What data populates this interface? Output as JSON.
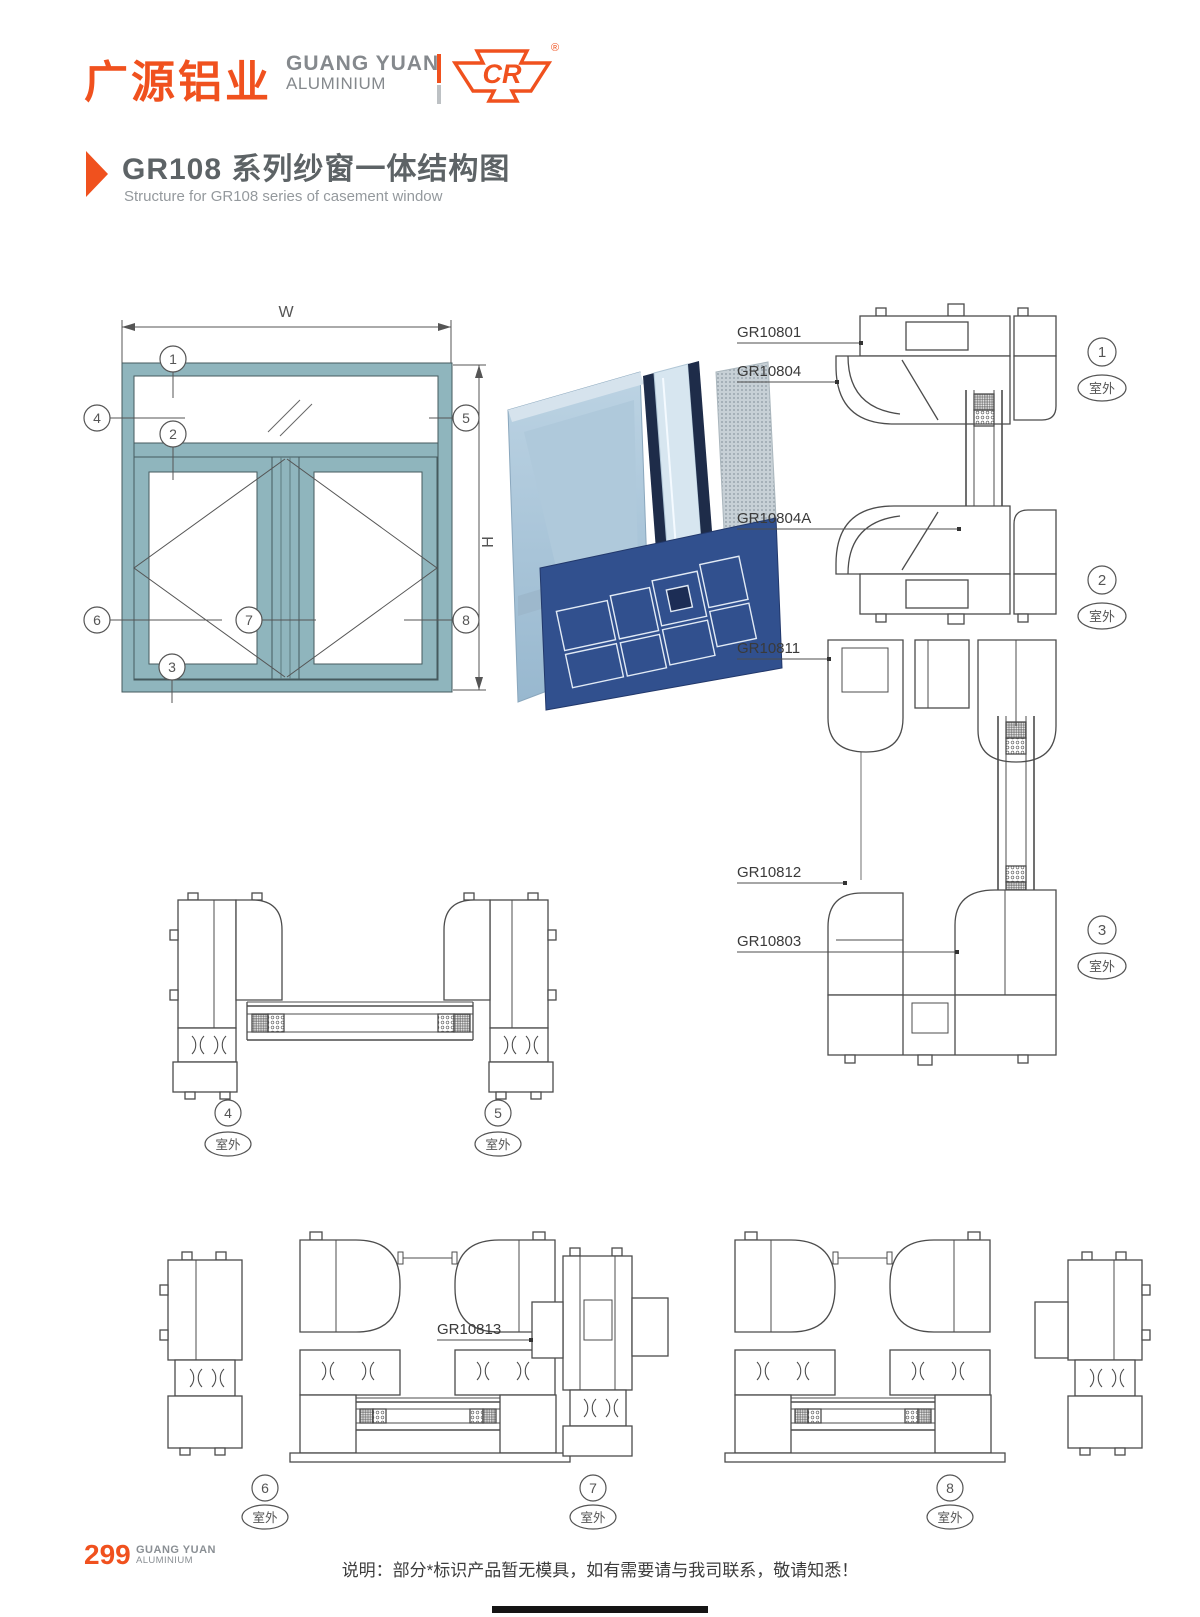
{
  "header": {
    "logo_cn": "广源铝业",
    "logo_en_top": "GUANG YUAN",
    "logo_en_bottom": "ALUMINIUM",
    "cr_text": "CR",
    "registered": "®"
  },
  "title": {
    "cn": "GR108 系列纱窗一体结构图",
    "en": "Structure for GR108 series of casement window"
  },
  "schematic": {
    "width_label": "W",
    "height_label": "H",
    "callouts": [
      "1",
      "2",
      "3",
      "4",
      "5",
      "6",
      "7",
      "8"
    ]
  },
  "sections": {
    "outdoor_label": "室外",
    "right_part_labels": [
      "GR10801",
      "GR10804",
      "GR10804A",
      "GR10811",
      "GR10812",
      "GR10803"
    ],
    "bottom_part_label": "GR10813",
    "view_numbers": [
      "1",
      "2",
      "3",
      "4",
      "5",
      "6",
      "7",
      "8"
    ]
  },
  "footer": {
    "page_number": "299",
    "brand_top": "GUANG YUAN",
    "brand_bottom": "ALUMINIUM",
    "note": "说明：部分*标识产品暂无模具，如有需要请与我司联系，敬请知悉！"
  },
  "colors": {
    "accent_orange": "#F0511E",
    "frame_teal": "#8FB5BD",
    "line_gray": "#4C4C4C",
    "render_blue": "#31508E"
  }
}
